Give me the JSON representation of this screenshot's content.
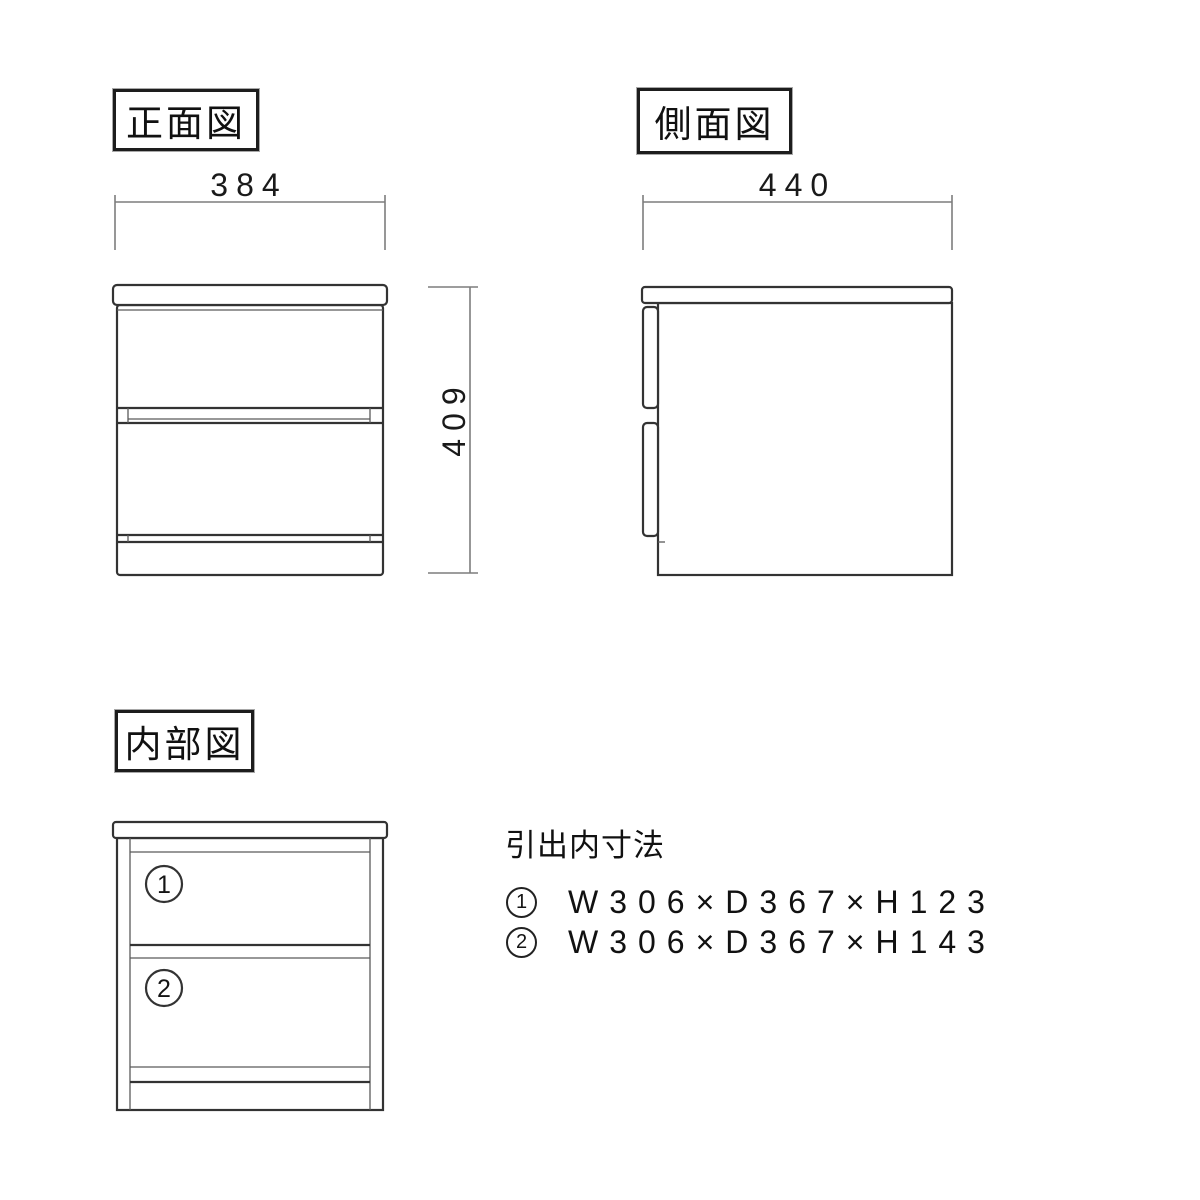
{
  "colors": {
    "background": "#ffffff",
    "object_line": "#333333",
    "dimension_line": "#7d7d7d",
    "text": "#141414"
  },
  "front_view": {
    "label": "正面図",
    "width_dim": "384",
    "height_dim": "409"
  },
  "side_view": {
    "label": "側面図",
    "depth_dim": "440"
  },
  "internal_view": {
    "label": "内部図",
    "compartments": [
      {
        "number": "1"
      },
      {
        "number": "2"
      }
    ]
  },
  "drawer_dimensions": {
    "heading": "引出内寸法",
    "rows": [
      {
        "number": "1",
        "dims": "W306×D367×H123"
      },
      {
        "number": "2",
        "dims": "W306×D367×H143"
      }
    ]
  }
}
